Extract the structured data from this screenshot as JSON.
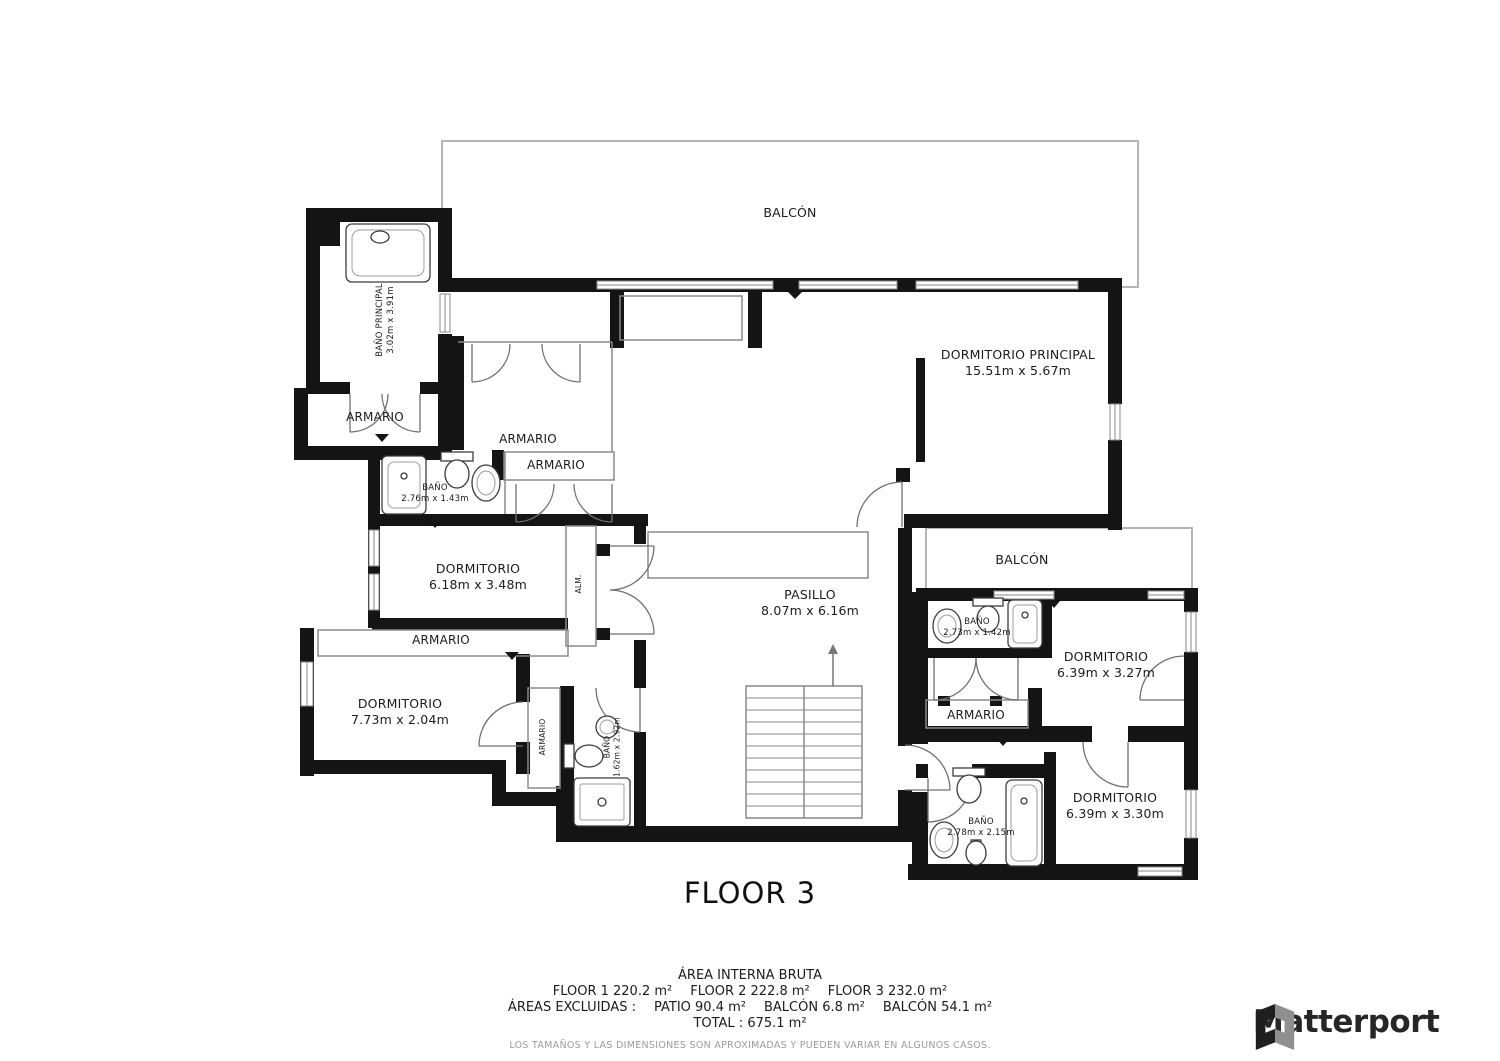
{
  "title": "FLOOR 3",
  "rooms": {
    "balcon_top": {
      "name": "BALCÓN"
    },
    "balcon_right": {
      "name": "BALCÓN"
    },
    "dormitorio_principal": {
      "name": "DORMITORIO PRINCIPAL",
      "dims": "15.51m x 5.67m"
    },
    "bano_principal": {
      "name": "BAÑO PRINCIPAL",
      "dims": "3.02m x 3.91m"
    },
    "armario_left": {
      "name": "ARMARIO"
    },
    "armario_walkin": {
      "name": "ARMARIO"
    },
    "armario_shelf": {
      "name": "ARMARIO"
    },
    "armario_mid": {
      "name": "ARMARIO"
    },
    "armario_vert": {
      "name": "ARMARIO"
    },
    "armario_right": {
      "name": "ARMARIO"
    },
    "bano_276": {
      "name": "BAÑO",
      "dims": "2.76m x 1.43m"
    },
    "bano_162": {
      "name": "BAÑO",
      "dims": "1.62m x 2.92m"
    },
    "bano_273": {
      "name": "BAÑO",
      "dims": "2.73m x 1.42m"
    },
    "bano_278": {
      "name": "BAÑO",
      "dims": "2.78m x 2.15m"
    },
    "alm": {
      "name": "ALM."
    },
    "dormitorio_618": {
      "name": "DORMITORIO",
      "dims": "6.18m x 3.48m"
    },
    "dormitorio_773": {
      "name": "DORMITORIO",
      "dims": "7.73m x 2.04m"
    },
    "dormitorio_327": {
      "name": "DORMITORIO",
      "dims": "6.39m x 3.27m"
    },
    "dormitorio_330": {
      "name": "DORMITORIO",
      "dims": "6.39m x 3.30m"
    },
    "pasillo": {
      "name": "PASILLO",
      "dims": "8.07m x 6.16m"
    }
  },
  "footer": {
    "heading": "ÁREA INTERNA BRUTA",
    "floors": [
      "FLOOR 1 220.2 m²",
      "FLOOR 2 222.8 m²",
      "FLOOR 3 232.0 m²"
    ],
    "excluded": [
      "ÁREAS EXCLUIDAS :",
      "PATIO 90.4 m²",
      "BALCÓN 6.8 m²",
      "BALCÓN 54.1 m²"
    ],
    "total": "TOTAL : 675.1 m²",
    "disclaimer": "LOS TAMAÑOS Y LAS DIMENSIONES SON APROXIMADAS Y PUEDEN VARIAR EN ALGUNOS CASOS."
  },
  "logo": {
    "text": "Matterport"
  },
  "colors": {
    "wall": "#141414",
    "thin_partition": "#8a8a8a",
    "balcony_outline": "#b5b5b5",
    "text": "#1b1b1b",
    "muted_text": "#9b9b9b",
    "logo_dark": "#262626",
    "logo_gray": "#8f8f8f"
  }
}
